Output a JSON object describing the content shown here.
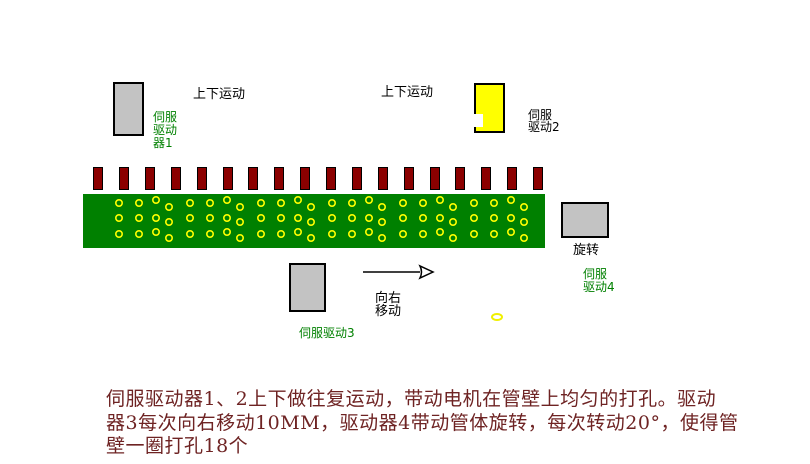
{
  "canvas": {
    "width": 810,
    "height": 464,
    "background": "#ffffff"
  },
  "colors": {
    "box_gray": "#c3c3c3",
    "box_yellow": "#ffff00",
    "bar_red": "#8b0000",
    "board_green": "#008000",
    "hole_yellow": "#ffff00",
    "label_green": "#008000",
    "label_black": "#000000",
    "description_maroon": "#6e2323"
  },
  "labels": {
    "servo1_motion": "上下运动",
    "servo2_motion": "上下运动",
    "servo1_name": "伺服\n驱动\n器1",
    "servo2_name": "伺服\n驱动2",
    "servo3_name": "伺服驱动3",
    "servo4_name": "伺服\n驱动4",
    "servo3_motion": "向右\n移动",
    "servo4_motion": "旋转"
  },
  "description": "伺服驱动器1、2上下做往复运动，带动电机在管壁上均匀的打孔。驱动\n器3每次向右移动10MM，驱动器4带动管体旋转，每次转动20°，使得管\n壁一圈打孔18个",
  "drill_bars": {
    "count": 18,
    "x_positions": [
      93,
      119,
      145,
      171,
      197,
      223,
      248,
      274,
      300,
      326,
      352,
      378,
      404,
      430,
      455,
      481,
      507,
      533
    ],
    "y": 167,
    "width": 10,
    "height": 23
  },
  "board": {
    "x": 83,
    "y": 194,
    "width": 462,
    "height": 54
  },
  "hole_pattern": {
    "x_start": 36,
    "x_step_cycle": [
      20,
      17,
      13,
      21
    ],
    "x_max": 452,
    "outer_radius": 4,
    "stroke_width": 1.6,
    "rows": [
      {
        "y": 9,
        "offsets": [
          0,
          0,
          -3,
          4
        ]
      },
      {
        "y": 24,
        "offsets": [
          0,
          0,
          0,
          4
        ]
      },
      {
        "y": 40,
        "offsets": [
          0,
          0,
          -2,
          4
        ]
      }
    ]
  },
  "arrow": {
    "line_length": 57,
    "head_length": 13,
    "head_height": 12
  }
}
